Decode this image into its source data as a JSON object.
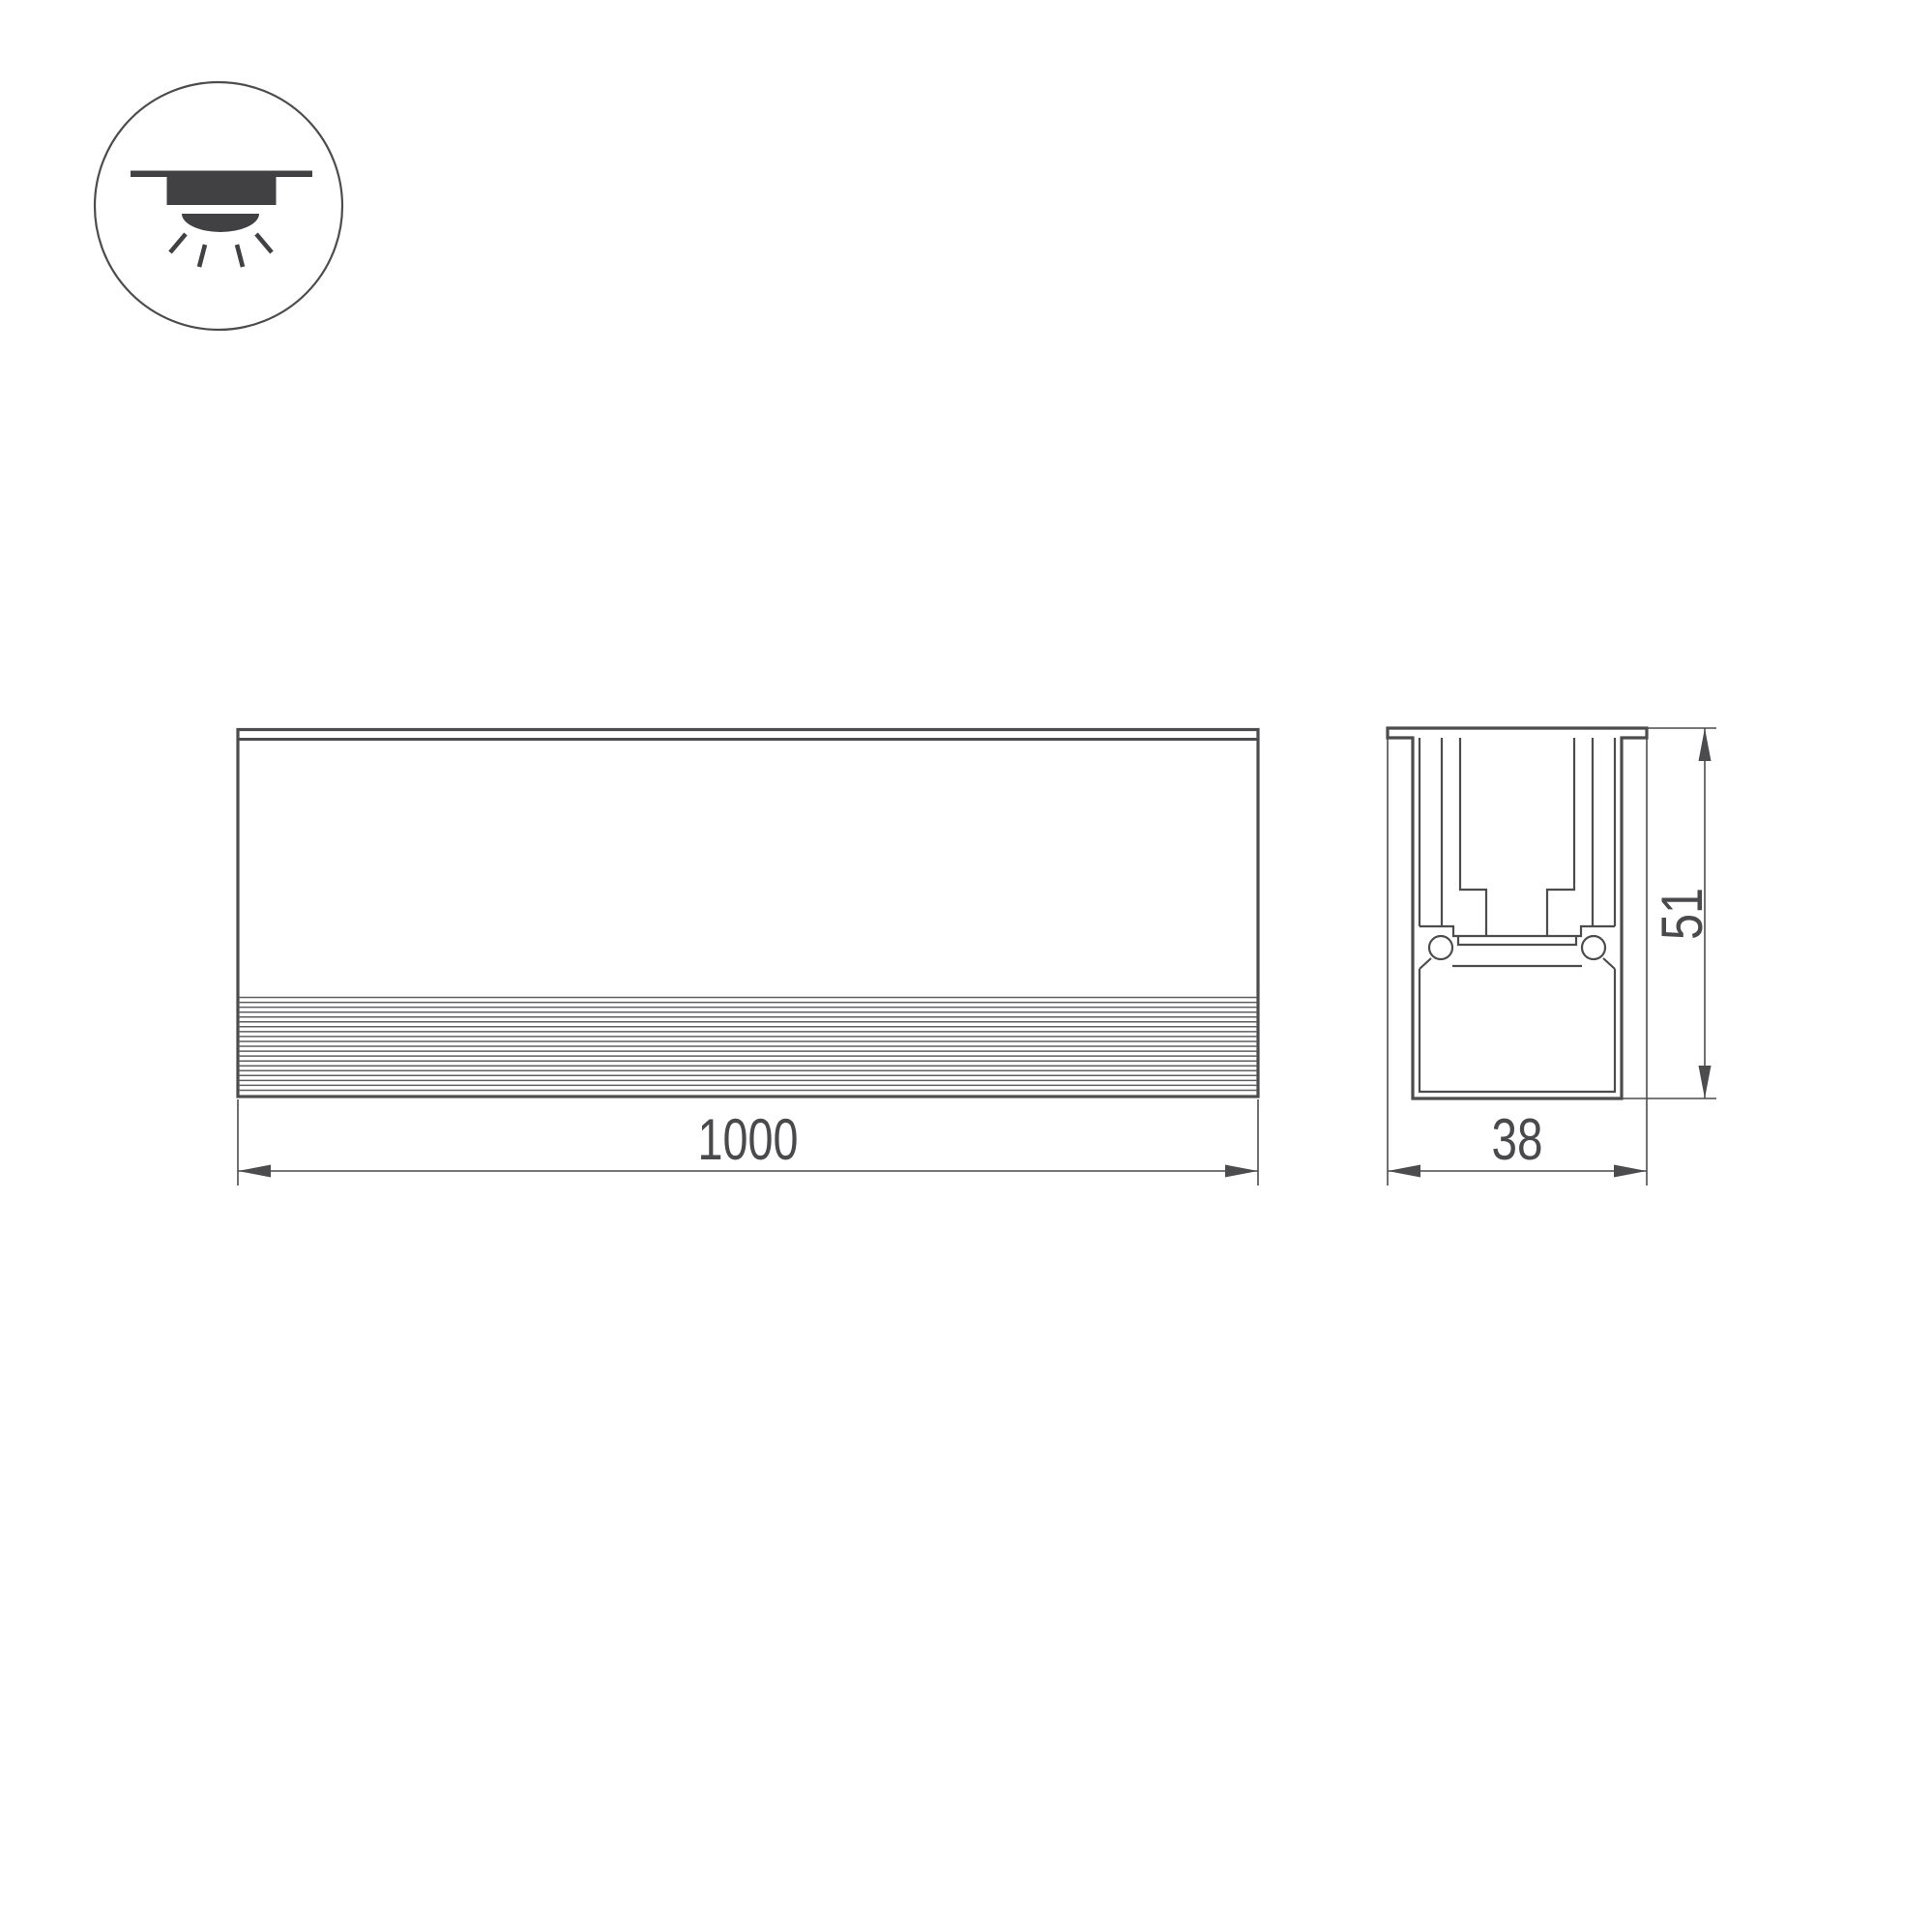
{
  "drawing": {
    "icon": {
      "name": "recessed-downlight",
      "shape": "circle-badge"
    },
    "front_view": {
      "length_label": "1000"
    },
    "section_view": {
      "width_label": "38",
      "height_label": "51"
    },
    "colors": {
      "line": "#4c4c4e",
      "rib_line": "#5f5f61",
      "text": "#4a4a4c",
      "icon_fill": "#414143",
      "background": "#ffffff"
    }
  }
}
